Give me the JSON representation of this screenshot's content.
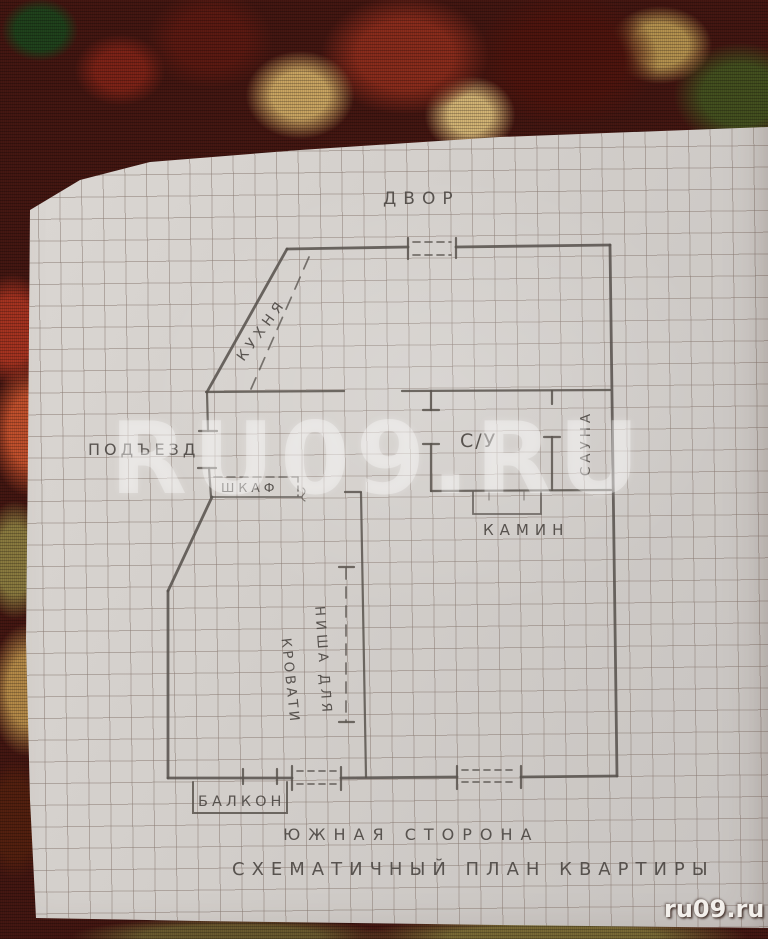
{
  "plan": {
    "labels": {
      "yard": "ДВОР",
      "kitchen": "КУХНЯ",
      "entrance": "ПОДЪЕЗД",
      "wardrobe": "ШКАФ",
      "bathroom": "С/У",
      "sauna": "САУНА",
      "fireplace": "КАМИН",
      "bed_niche_line1": "НИША ДЛЯ",
      "bed_niche_line2": "КРОВАТИ",
      "balcony": "БАЛКОН",
      "south_side": "ЮЖНАЯ СТОРОНА",
      "title": "СХЕМАТИЧНЫЙ ПЛАН КВАРТИРЫ"
    }
  },
  "watermarks": {
    "center": "RU09.RU",
    "corner": "ru09.ru"
  },
  "colors": {
    "pencil": "#59534e",
    "paper": "#d4d0cc",
    "grid_line": "#887971",
    "tapestry_base": "#451712",
    "watermark": "#ffffff"
  }
}
